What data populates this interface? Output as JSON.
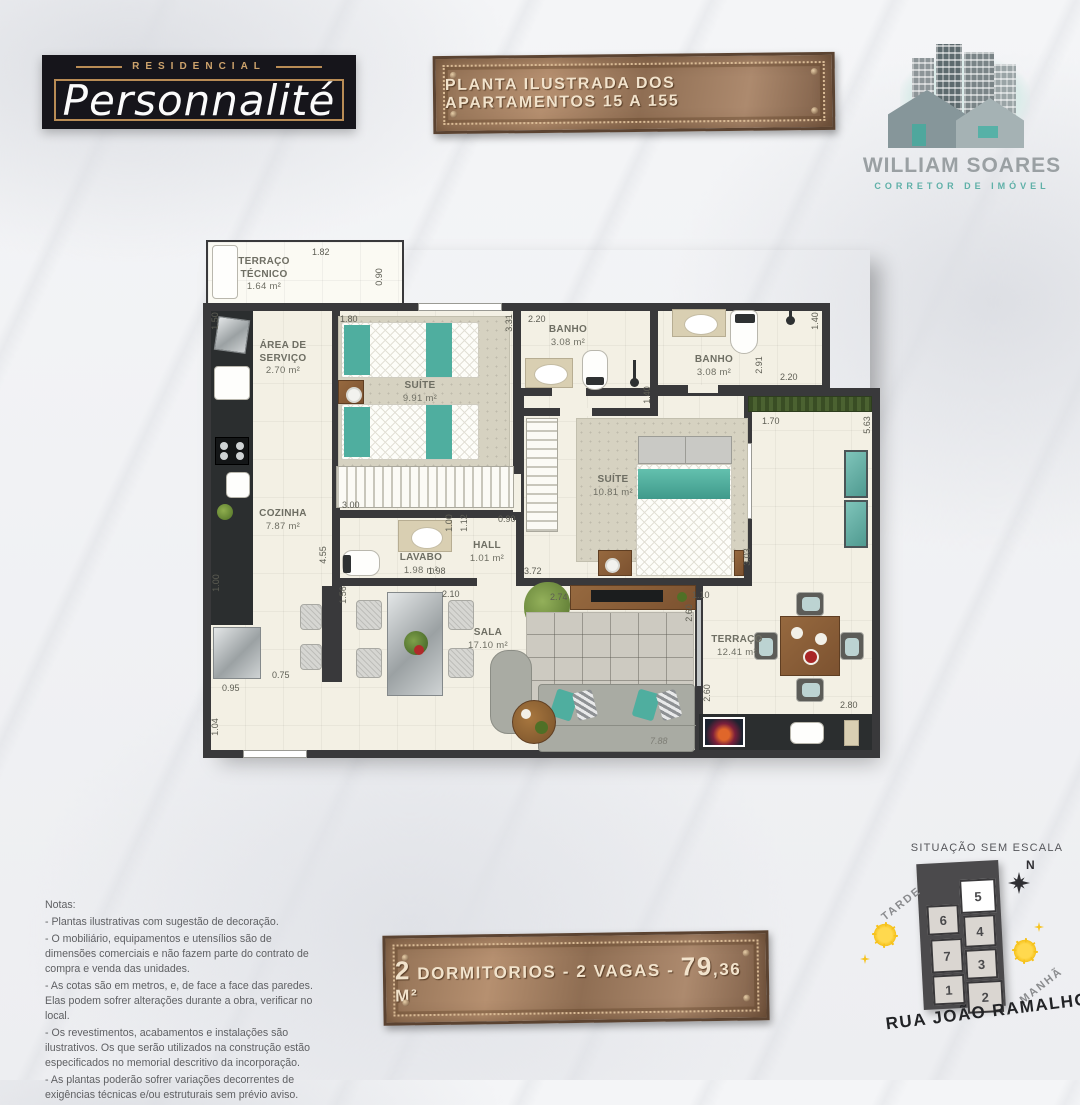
{
  "logo": {
    "top": "RESIDENCIAL",
    "name": "Personnalité"
  },
  "top_plaque": {
    "text": "PLANTA ILUSTRADA DOS APARTAMENTOS 15 A 155"
  },
  "brand": {
    "name": "WILLIAM SOARES",
    "tagline": "CORRETOR DE IMÓVEL"
  },
  "plan": {
    "rooms": [
      {
        "name": "TERRAÇO TÉCNICO",
        "area": "1.64 m²"
      },
      {
        "name": "ÁREA DE SERVIÇO",
        "area": "2.70 m²"
      },
      {
        "name": "SUÍTE",
        "area": "9.91 m²"
      },
      {
        "name": "BANHO",
        "area": "3.08 m²"
      },
      {
        "name": "BANHO",
        "area": "3.08 m²"
      },
      {
        "name": "SUÍTE",
        "area": "10.81 m²"
      },
      {
        "name": "COZINHA",
        "area": "7.87 m²"
      },
      {
        "name": "LAVABO",
        "area": "1.98 m²"
      },
      {
        "name": "HALL",
        "area": "1.01 m²"
      },
      {
        "name": "SALA",
        "area": "17.10 m²"
      },
      {
        "name": "TERRAÇO",
        "area": "12.41 m²"
      }
    ],
    "dims": [
      "1.82",
      "0.90",
      "1.50",
      "1.80",
      "2.20",
      "3.31",
      "1.40",
      "1.40",
      "2.20",
      "2.91",
      "1.70",
      "5.63",
      "3.00",
      "1.00",
      "1.12",
      "0.90",
      "1.98",
      "2.10",
      "3.72",
      "2.74",
      "1.10",
      "3.03",
      "4.55",
      "1.56",
      "0.75",
      "0.95",
      "1.04",
      "1.00",
      "2.60",
      "2.60",
      "2.80",
      "7.88"
    ]
  },
  "notes": {
    "title": "Notas:",
    "lines": [
      "- Plantas ilustrativas com sugestão de decoração.",
      "- O mobiliário, equipamentos e utensílios são de dimensões comerciais e não fazem parte do contrato de compra e venda das unidades.",
      "- As cotas são em metros, e, de face a face das paredes. Elas podem sofrer alterações durante a obra, verificar no local.",
      "- Os revestimentos, acabamentos e instalações são ilustrativos. Os que serão utilizados na construção estão especificados no memorial descritivo da incorporação.",
      "- As plantas poderão sofrer variações decorrentes de exigências técnicas e/ou estruturais sem prévio aviso."
    ]
  },
  "bottom_plaque": {
    "num1": "2",
    "mid": " DORMITORIOS - 2 VAGAS - ",
    "num2": "79",
    "unit": ",36 M²"
  },
  "situation": {
    "title": "SITUAÇÃO SEM ESCALA",
    "north": "N",
    "sun_left": "TARDE",
    "sun_right": "MANHÃ",
    "street": "RUA JOÃO RAMALHO",
    "units": [
      "1",
      "2",
      "3",
      "4",
      "5",
      "6",
      "7"
    ]
  },
  "colors": {
    "accent_teal": "#4fae9f",
    "bronze": "#9a7659",
    "gold": "#b98c55",
    "wall": "#39393b"
  }
}
